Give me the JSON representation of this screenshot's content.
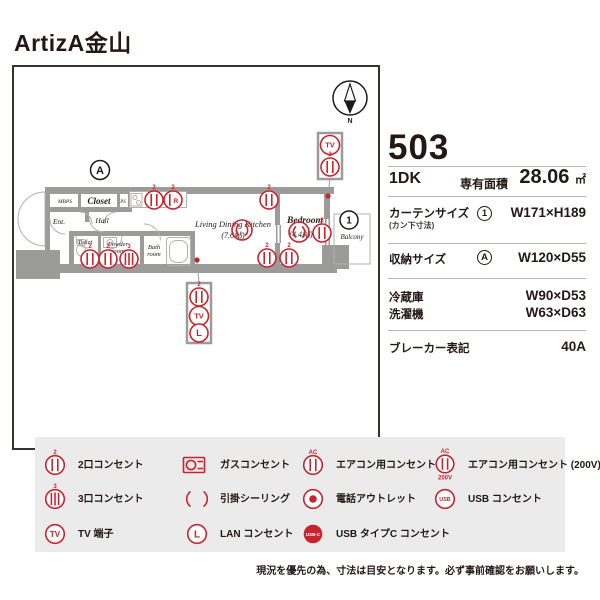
{
  "title": "ArtizA金山",
  "plan": {
    "compass_n": "N",
    "marker_a": "A",
    "balcony_marker": "1",
    "rooms": {
      "mbps": "MBPS",
      "closet": "Closet",
      "ps": "PS",
      "ent": "Ent.",
      "hall": "Hall",
      "toilet": "Toilet",
      "powder1": "Powder",
      "powder2": "room",
      "bath1": "Bath",
      "bath2": "room",
      "ldk": "Living Dining Kitchen",
      "ldk_size": "(7.6帖)",
      "bedroom": "Bedroom",
      "bedroom_size": "(4.4帖)",
      "balcony": "Balcony"
    },
    "marks": {
      "outlet2": "2",
      "outlet3": "3",
      "tv": "TV",
      "lan": "L",
      "fridge": "R"
    }
  },
  "info": {
    "room_number": "503",
    "layout": "1DK",
    "area_label": "専有面積",
    "area_value": "28.06",
    "area_unit": "㎡",
    "curtain": {
      "label": "カーテンサイズ",
      "sublabel": "(カン下寸法)",
      "marker": "1",
      "value": "W171×H189"
    },
    "storage": {
      "label": "収納サイズ",
      "marker": "A",
      "value": "W120×D55"
    },
    "fridge": {
      "label": "冷蔵庫",
      "value": "W90×D53"
    },
    "washer": {
      "label": "洗濯機",
      "value": "W63×D63"
    },
    "breaker": {
      "label": "ブレーカー表記",
      "value": "40A"
    }
  },
  "legend": {
    "items": [
      {
        "type": "outlet2",
        "mark": "2",
        "label": "2口コンセント"
      },
      {
        "type": "gas",
        "label": "ガスコンセント"
      },
      {
        "type": "ac",
        "mark": "AC",
        "label": "エアコン用コンセント"
      },
      {
        "type": "ac200",
        "mark": "AC",
        "mark2": "200V",
        "label": "エアコン用コンセント (200V)"
      },
      {
        "type": "outlet3",
        "mark": "3",
        "label": "3口コンセント"
      },
      {
        "type": "ceiling",
        "label": "引掛シーリング"
      },
      {
        "type": "phone",
        "label": "電話アウトレット"
      },
      {
        "type": "usb",
        "mark": "USB",
        "label": "USB コンセント"
      },
      {
        "type": "tv",
        "mark": "TV",
        "label": "TV 端子"
      },
      {
        "type": "lan",
        "mark": "L",
        "label": "LAN コンセント"
      },
      {
        "type": "usbc",
        "mark": "USB-C",
        "label": "USB タイプC コンセント"
      }
    ]
  },
  "note": "現況を優先の為、寸法は目安となります。必ず事前確認をお願いします。",
  "colors": {
    "accent_red": "#c9242e",
    "wall_gray": "#9b9b99",
    "text_dark": "#231815",
    "legend_bg": "#ebebeb"
  }
}
